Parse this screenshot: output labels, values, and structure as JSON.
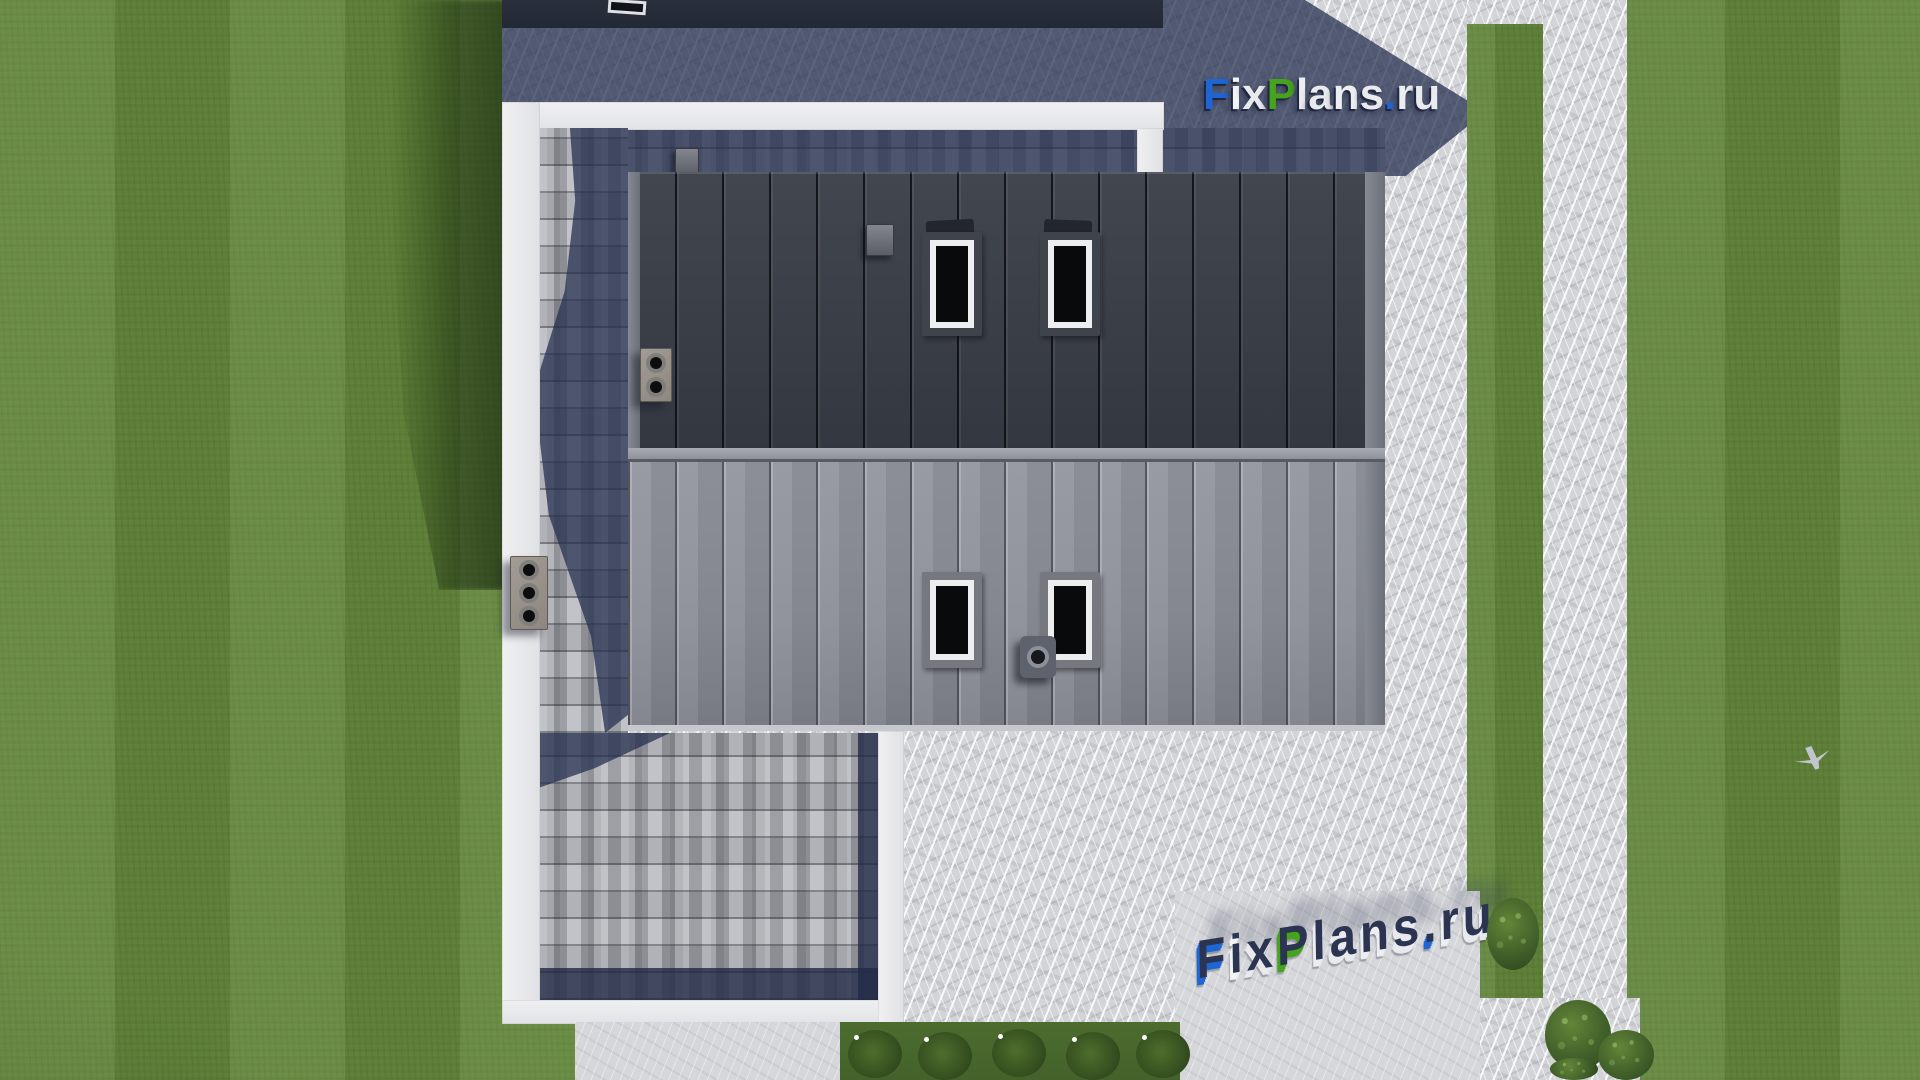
{
  "scene": {
    "description": "Aerial top-down 3D architectural render (roof plan view) of a modern house: charcoal and gray standing-seam metal roof slopes with skylights and vents, gray shingled side roof strips, white parapet fascia, streaked concrete paving apron, lawn with walking paths, flower bed and shrubs",
    "palette": {
      "lawn": "#64883C",
      "lawn_shadow": "#2E481E",
      "concrete": "#D2D4D8",
      "concrete_shadow": "#4A536E",
      "fascia_white": "#ECECEF",
      "shingle": "#AFB1B8",
      "roof_upper": "#3C4049",
      "roof_lower": "#8B8E97",
      "ridge_cap": "#9B9EA6",
      "skylight_glass": "#090A0C",
      "skylight_frame": "#ECEEF0"
    }
  },
  "brand": {
    "name": "FixPlans.ru",
    "top_color": "#2B3450",
    "letters": [
      {
        "ch": "F",
        "face": "#1E66D6"
      },
      {
        "ch": "i",
        "face": "#F2F3F5"
      },
      {
        "ch": "x",
        "face": "#E8EAEE"
      },
      {
        "ch": "P",
        "face": "#46A31C"
      },
      {
        "ch": "l",
        "face": "#EDEEF1"
      },
      {
        "ch": "a",
        "face": "#E8EAEE"
      },
      {
        "ch": "n",
        "face": "#EDEEF1"
      },
      {
        "ch": "s",
        "face": "#E8EAEE"
      },
      {
        "ch": ".",
        "face": "#1E66D6"
      },
      {
        "ch": "r",
        "face": "#EDEEF1"
      },
      {
        "ch": "u",
        "face": "#E8EAEE"
      }
    ]
  },
  "watermark": {
    "text": "FixPlans.ru"
  }
}
